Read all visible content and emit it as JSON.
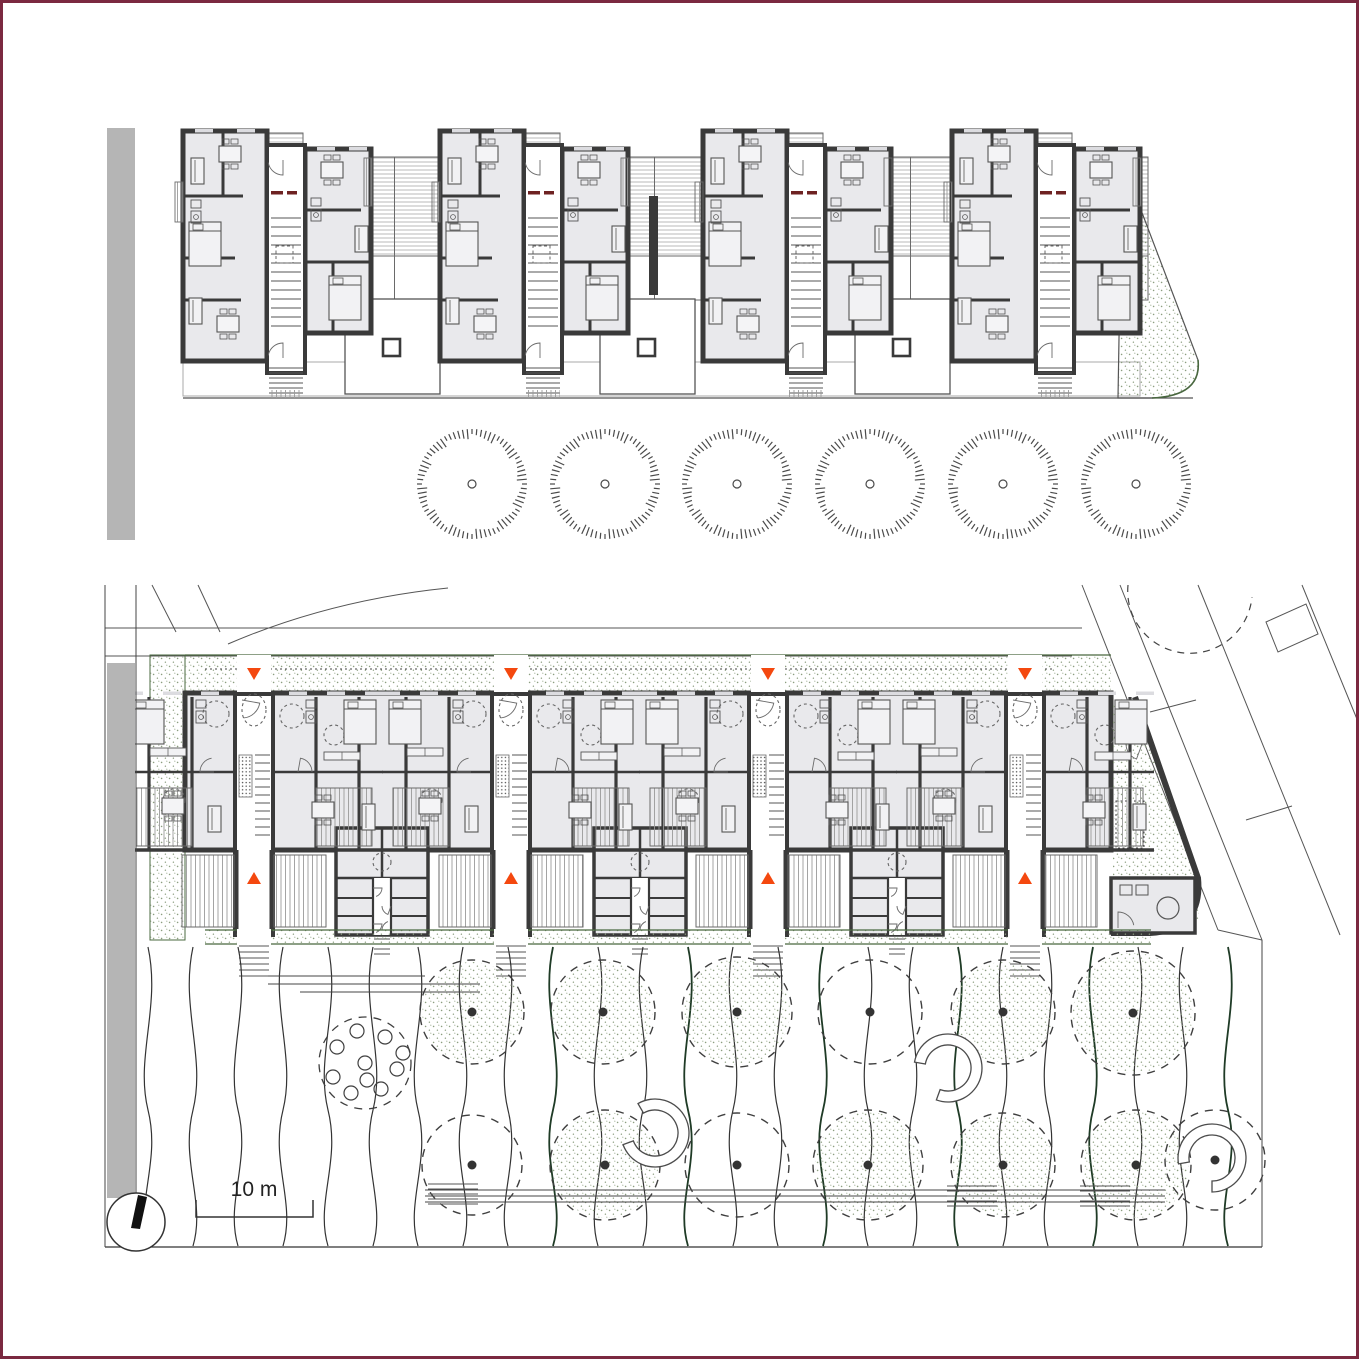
{
  "drawing": {
    "title": "Housing project — upper floor plan and ground floor site plan",
    "scale_label": "10 m"
  },
  "colors": {
    "border": "#7b2940",
    "wall": "#3a3a3a",
    "room_fill": "#e9e9ec",
    "line": "#555555",
    "thin": "#6a6a6a",
    "hatch": "#a8a8a8",
    "street_gray": "#b5b5b5",
    "green": "#49683f",
    "dark_green": "#1f3b26",
    "stipple": "#8c9e80",
    "orange": "#f4480f",
    "accent_red": "#6e2222",
    "black": "#222222",
    "white": "#ffffff"
  },
  "upper_plan": {
    "street_band": [
      107,
      128,
      28,
      412
    ],
    "modules_x": [
      183,
      440,
      703,
      952
    ],
    "module_w": 166,
    "wing_left": [
      0,
      131,
      84,
      230
    ],
    "wing_right": [
      122,
      149,
      66,
      184
    ],
    "core": [
      84,
      145,
      38,
      228
    ],
    "balcony_top": [
      86,
      133,
      34,
      20
    ],
    "roof_gaps": [
      [
        349,
        440
      ],
      [
        606,
        703
      ],
      [
        869,
        952
      ],
      [
        1118,
        1148
      ]
    ],
    "dark_bar": [
      649,
      196,
      9,
      99
    ],
    "courtyards": [
      [
        345,
        299,
        95,
        95
      ],
      [
        600,
        299,
        95,
        95
      ],
      [
        855,
        299,
        95,
        95
      ]
    ],
    "ground_line_y": 398,
    "terrace_band_y": 362,
    "right_end_path": "M1122,160 L1198,360 Q1202,396 1152,398 L1118,398 Z",
    "furniture": [
      {
        "t": "table",
        "x": 36,
        "y": 146
      },
      {
        "t": "sofa",
        "x": 8,
        "y": 158
      },
      {
        "t": "bed",
        "x": 6,
        "y": 222
      },
      {
        "t": "bath",
        "x": 8,
        "y": 200
      },
      {
        "t": "table",
        "x": 34,
        "y": 316
      },
      {
        "t": "sofa",
        "x": 6,
        "y": 298
      },
      {
        "t": "table",
        "x": 138,
        "y": 162
      },
      {
        "t": "sofa",
        "x": 172,
        "y": 226
      },
      {
        "t": "bed",
        "x": 146,
        "y": 276
      },
      {
        "t": "bath",
        "x": 128,
        "y": 198
      }
    ]
  },
  "lower_plan": {
    "band": [
      185,
      693,
      926,
      157
    ],
    "cores_x": [
      254,
      511,
      768,
      1025
    ],
    "clusters_x": [
      382,
      640,
      897
    ],
    "partition_dx": [
      -105,
      -62,
      62,
      105
    ],
    "window_dx": [
      -120,
      -82,
      -44,
      44,
      82,
      120
    ],
    "deck_dx": [
      -118,
      62
    ],
    "south_hatch_dx": [
      -72,
      20
    ],
    "south_wall_y": 850,
    "band_bottom_y": 935,
    "markers": {
      "top_y": 668,
      "bottom_y": 872,
      "half": 7,
      "h": 12
    },
    "garden_strip": [
      185,
      655,
      926,
      38
    ],
    "dotted_line_y": 669,
    "green_strip": [
      205,
      930,
      946,
      14
    ],
    "left_strip": [
      150,
      655,
      35,
      285
    ],
    "dashed_circles": [
      [
        -38,
        714,
        13
      ],
      [
        38,
        716,
        12
      ],
      [
        -80,
        800,
        11
      ],
      [
        80,
        735,
        10
      ]
    ],
    "furniture": [
      {
        "t": "bed",
        "x": -122,
        "y": 700
      },
      {
        "t": "bed",
        "x": 90,
        "y": 700
      },
      {
        "t": "table",
        "x": -92,
        "y": 798
      },
      {
        "t": "table",
        "x": 58,
        "y": 802
      },
      {
        "t": "sofa",
        "x": -46,
        "y": 806
      },
      {
        "t": "sofa",
        "x": 108,
        "y": 804
      },
      {
        "t": "bath",
        "x": -58,
        "y": 700
      },
      {
        "t": "bath",
        "x": 52,
        "y": 700
      },
      {
        "t": "wardrobe",
        "x": -104,
        "y": 748
      },
      {
        "t": "wardrobe",
        "x": 70,
        "y": 752
      }
    ],
    "site_h_lines": [
      [
        105,
        628,
        1082
      ],
      [
        105,
        656,
        1072
      ]
    ],
    "curvy_paths": [
      "M152,585 L176,632",
      "M198,585 L220,632",
      "M228,644 Q330,600 448,588"
    ],
    "right_site": {
      "diagonals": [
        [
          1082,
          585,
          1218,
          930
        ],
        [
          1120,
          585,
          1262,
          940
        ],
        [
          1198,
          585,
          1340,
          935
        ],
        [
          1302,
          585,
          1359,
          724
        ]
      ],
      "connectors": [
        [
          1218,
          930,
          1262,
          940
        ],
        [
          1150,
          712,
          1196,
          700
        ],
        [
          1246,
          820,
          1292,
          806
        ]
      ],
      "plot_rect": "M1266,622 L1306,604 L1318,634 L1278,652 Z",
      "dashed_arc": "M1128,585 A62,62 0 0 0 1252,597"
    },
    "right_end": {
      "diag_wall": [
        1135,
        697,
        1198,
        878
      ],
      "corner_path": "M1135,697 L1198,878 Q1203,930 1150,933 L1111,933",
      "room": [
        1111,
        878,
        84,
        55
      ],
      "circle": [
        1168,
        908,
        11
      ],
      "dotted_sq": [
        1116,
        801,
        28,
        47
      ],
      "stipple_poly": "M1113,700 L1133,698 L1196,872 L1199,920 L1150,928 L1113,928 Z"
    }
  },
  "trees_row": {
    "y": 484,
    "r": 55,
    "xs": [
      472,
      605,
      737,
      870,
      1003,
      1136
    ]
  },
  "landscape": {
    "waves": {
      "x0": 148,
      "x1": 1240,
      "step": 45,
      "y0": 947,
      "y1": 1246,
      "amp": 13,
      "green_min_x": 430
    },
    "canopies": [
      {
        "x": 472,
        "y": 1012,
        "r": 52,
        "s": 1
      },
      {
        "x": 603,
        "y": 1012,
        "r": 52,
        "s": 1
      },
      {
        "x": 737,
        "y": 1012,
        "r": 55,
        "s": 1
      },
      {
        "x": 870,
        "y": 1012,
        "r": 52,
        "s": 0
      },
      {
        "x": 1003,
        "y": 1012,
        "r": 52,
        "s": 1
      },
      {
        "x": 1133,
        "y": 1013,
        "r": 62,
        "s": 1
      },
      {
        "x": 472,
        "y": 1165,
        "r": 50,
        "s": 0
      },
      {
        "x": 605,
        "y": 1165,
        "r": 55,
        "s": 1
      },
      {
        "x": 737,
        "y": 1165,
        "r": 52,
        "s": 0
      },
      {
        "x": 868,
        "y": 1165,
        "r": 55,
        "s": 1
      },
      {
        "x": 1003,
        "y": 1165,
        "r": 52,
        "s": 1
      },
      {
        "x": 1136,
        "y": 1165,
        "r": 55,
        "s": 1
      },
      {
        "x": 1215,
        "y": 1160,
        "r": 50,
        "s": 0
      }
    ],
    "bulb_bed": {
      "cx": 365,
      "cy": 1063,
      "r": 46,
      "circles": [
        [
          0,
          0
        ],
        [
          32,
          6
        ],
        [
          16,
          26
        ],
        [
          -14,
          30
        ],
        [
          -32,
          14
        ],
        [
          -28,
          -16
        ],
        [
          -8,
          -32
        ],
        [
          20,
          -26
        ],
        [
          38,
          -10
        ],
        [
          2,
          17
        ]
      ]
    },
    "hedges": [
      [
        655,
        1133,
        200
      ],
      [
        948,
        1068,
        150
      ],
      [
        1212,
        1158,
        130
      ]
    ],
    "paths_upper": [
      [
        268,
        976,
        425
      ],
      [
        268,
        984,
        480
      ],
      [
        300,
        992,
        480
      ]
    ],
    "paths_lower": [
      [
        425,
        1190,
        1165
      ],
      [
        425,
        1196,
        1165
      ],
      [
        425,
        1202,
        1165
      ]
    ],
    "tread_groups": [
      [
        428,
        1184
      ],
      [
        947,
        1186
      ],
      [
        1080,
        1186
      ]
    ],
    "bottom_line": [
      105,
      1247,
      1262
    ],
    "verticals": [
      [
        105,
        585,
        1247
      ],
      [
        136,
        585,
        1198
      ],
      [
        1262,
        940,
        1247
      ]
    ]
  },
  "annotations": {
    "scale_label": "10 m",
    "scale_bar": [
      196,
      1200,
      313,
      1217
    ],
    "north_arrow": {
      "c": [
        136,
        1222
      ],
      "r": 29,
      "needle": [
        [
          131,
          1228
        ],
        [
          140,
          1229
        ],
        [
          147,
          1197
        ],
        [
          138,
          1195
        ]
      ]
    }
  }
}
